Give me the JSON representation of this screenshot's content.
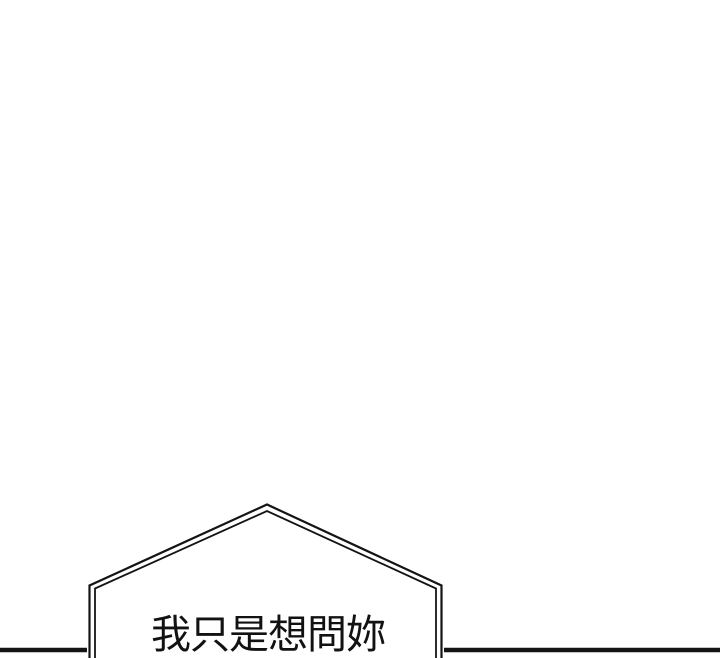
{
  "colors": {
    "background": "#ffffff",
    "ink": "#141414"
  },
  "bubble": {
    "text": "我只是想問妳"
  }
}
